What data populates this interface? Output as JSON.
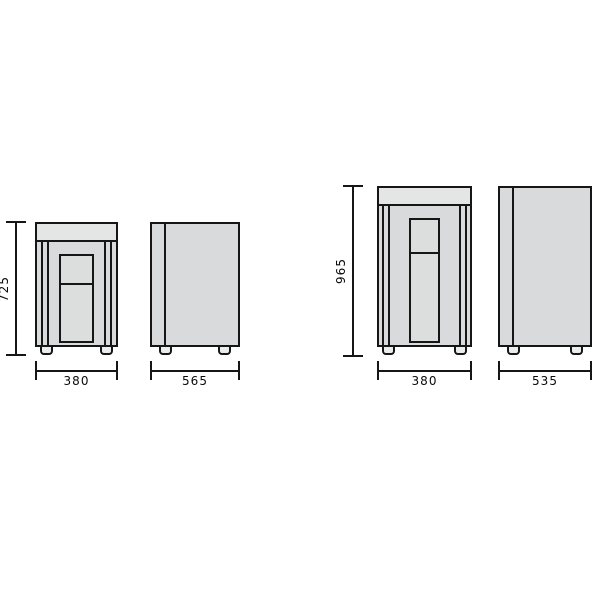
{
  "diagram": {
    "type": "product-dimension-drawing",
    "background": "#ffffff",
    "line_color": "#161616",
    "body_fill": "#d9dadb",
    "top_panel_fill": "#e4e5e5",
    "units": [
      {
        "name": "unit-a",
        "front": {
          "height_label": "725",
          "width_label": "380"
        },
        "side": {
          "depth_label": "565"
        }
      },
      {
        "name": "unit-b",
        "front": {
          "height_label": "965",
          "width_label": "380"
        },
        "side": {
          "depth_label": "535"
        }
      }
    ]
  }
}
